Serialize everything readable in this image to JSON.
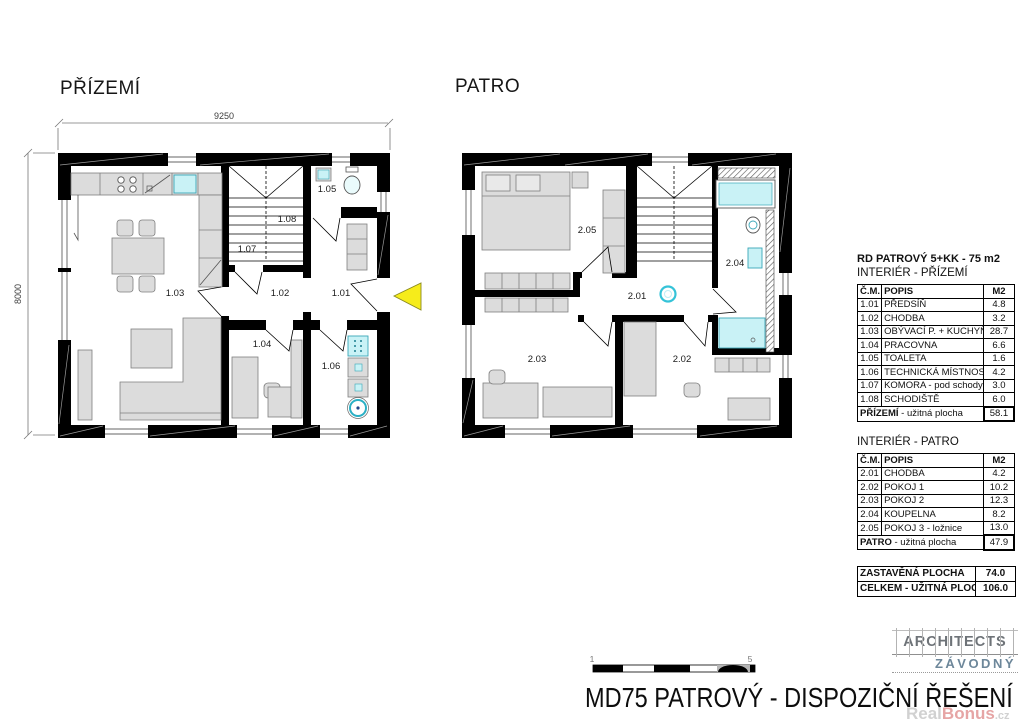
{
  "plans": {
    "prizemi": {
      "title": "PŘÍZEMÍ",
      "dim_top": "9250",
      "dim_left": "8000",
      "rooms": {
        "r101": "1.01",
        "r102": "1.02",
        "r103": "1.03",
        "r104": "1.04",
        "r105": "1.05",
        "r106": "1.06",
        "r107": "1.07",
        "r108": "1.08"
      }
    },
    "patro": {
      "title": "PATRO",
      "rooms": {
        "r201": "2.01",
        "r202": "2.02",
        "r203": "2.03",
        "r204": "2.04",
        "r205": "2.05"
      }
    }
  },
  "tables": {
    "ground": {
      "header_title": "RD PATROVÝ 5+KK - 75 m2",
      "header_subtitle": "INTERIÉR - PŘÍZEMÍ",
      "col_num": "Č.M.",
      "col_desc": "POPIS",
      "col_area": "M2",
      "rows": [
        {
          "num": "1.01",
          "desc": "PŘEDSÍŇ",
          "area": "4.8"
        },
        {
          "num": "1.02",
          "desc": "CHODBA",
          "area": "3.2"
        },
        {
          "num": "1.03",
          "desc": "OBÝVACÍ P. + KUCHYŇ",
          "area": "28.7"
        },
        {
          "num": "1.04",
          "desc": "PRACOVNA",
          "area": "6.6"
        },
        {
          "num": "1.05",
          "desc": "TOALETA",
          "area": "1.6"
        },
        {
          "num": "1.06",
          "desc": "TECHNICKÁ MÍSTNOST",
          "area": "4.2"
        },
        {
          "num": "1.07",
          "desc": "KOMORA - pod schody",
          "area": "3.0"
        },
        {
          "num": "1.08",
          "desc": "SCHODIŠTĚ",
          "area": "6.0"
        }
      ],
      "footer": {
        "room": "PŘÍZEMÍ",
        "suffix": " - užitná plocha",
        "value": "58.1"
      }
    },
    "upper": {
      "title": "INTERIÉR - PATRO",
      "col_num": "Č.M.",
      "col_desc": "POPIS",
      "col_area": "M2",
      "rows": [
        {
          "num": "2.01",
          "desc": "CHODBA",
          "area": "4.2"
        },
        {
          "num": "2.02",
          "desc": "POKOJ 1",
          "area": "10.2"
        },
        {
          "num": "2.03",
          "desc": "POKOJ 2",
          "area": "12.3"
        },
        {
          "num": "2.04",
          "desc": "KOUPELNA",
          "area": "8.2"
        },
        {
          "num": "2.05",
          "desc": "POKOJ 3 - ložnice",
          "area": "13.0"
        }
      ],
      "footer": {
        "room": "PATRO",
        "suffix": " - užitná plocha",
        "value": "47.9"
      }
    },
    "summary": {
      "rows": [
        {
          "label": "ZASTAVĚNÁ PLOCHA",
          "value": "74.0"
        },
        {
          "label": "CELKEM - UŽITNÁ PLOCHA",
          "value": "106.0"
        }
      ]
    }
  },
  "scalebar": {
    "label_start": "1",
    "label_end": "5"
  },
  "footer": {
    "drawing_title": "MD75 PATROVÝ - DISPOZIČNÍ ŘEŠENÍ",
    "logo_top": "ARCHITECTS",
    "logo_bottom": "ZÁVODNÝ",
    "watermark_part1": "Real",
    "watermark_part2": "Bonus",
    "watermark_part3": ".cz"
  },
  "colors": {
    "wall": "#000000",
    "furniture": "#dcdcdc",
    "fixture_cyan": "#c9f2f6",
    "arrow_yellow": "#f6ec1b",
    "logo_gray": "#6e7378",
    "logo_blue": "#6d879a"
  }
}
